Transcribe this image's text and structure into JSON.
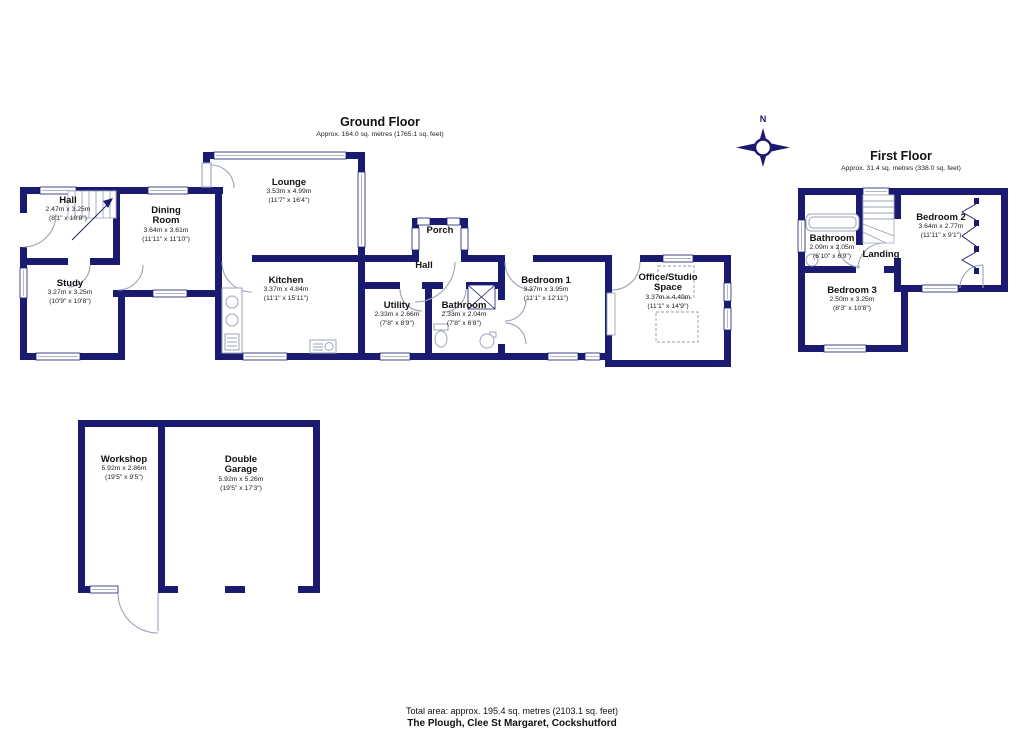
{
  "colors": {
    "wall": "#1a1a70",
    "fixture_line": "#9aa3b8"
  },
  "compass": {
    "north_label": "N"
  },
  "ground_floor": {
    "title": "Ground Floor",
    "subtitle": "Approx. 164.0 sq. metres (1765.1 sq. feet)",
    "rooms": [
      {
        "name": "Hall",
        "dim_m": "2.47m x 3.25m",
        "dim_ft": "(8'1\" x 10'8\")"
      },
      {
        "name": "Dining Room",
        "dim_m": "3.64m x 3.61m",
        "dim_ft": "(11'11\" x 11'10\")"
      },
      {
        "name": "Study",
        "dim_m": "3.27m x 3.25m",
        "dim_ft": "(10'9\" x 10'8\")"
      },
      {
        "name": "Lounge",
        "dim_m": "3.53m x 4.99m",
        "dim_ft": "(11'7\" x 16'4\")"
      },
      {
        "name": "Kitchen",
        "dim_m": "3.37m x 4.84m",
        "dim_ft": "(11'1\" x 15'11\")"
      },
      {
        "name": "Porch"
      },
      {
        "name": "Hall"
      },
      {
        "name": "Utility",
        "dim_m": "2.33m x 2.66m",
        "dim_ft": "(7'8\" x 8'9\")"
      },
      {
        "name": "Bathroom",
        "dim_m": "2.33m x 2.04m",
        "dim_ft": "(7'8\" x 6'8\")"
      },
      {
        "name": "Bedroom 1",
        "dim_m": "3.37m x 3.95m",
        "dim_ft": "(11'1\" x 12'11\")"
      },
      {
        "name": "Office/Studio Space",
        "dim_m": "3.37m x 4.49m",
        "dim_ft": "(11'1\" x 14'9\")"
      }
    ]
  },
  "first_floor": {
    "title": "First Floor",
    "subtitle": "Approx. 31.4 sq. metres (338.0 sq. feet)",
    "rooms": [
      {
        "name": "Bathroom",
        "dim_m": "2.09m x 2.05m",
        "dim_ft": "(6'10\" x 6'9\")"
      },
      {
        "name": "Bedroom 2",
        "dim_m": "3.64m x 2.77m",
        "dim_ft": "(11'11\" x 9'1\")"
      },
      {
        "name": "Landing"
      },
      {
        "name": "Bedroom 3",
        "dim_m": "2.50m x 3.25m",
        "dim_ft": "(8'3\" x 10'8\")"
      }
    ]
  },
  "outbuilding": {
    "rooms": [
      {
        "name": "Workshop",
        "dim_m": "5.92m x 2.86m",
        "dim_ft": "(19'5\" x 9'5\")"
      },
      {
        "name": "Double Garage",
        "dim_m": "5.92m x 5.26m",
        "dim_ft": "(19'5\" x 17'3\")"
      }
    ]
  },
  "footer": {
    "total_area": "Total area: approx. 195.4 sq. metres (2103.1 sq. feet)",
    "address": "The Plough, Clee St Margaret, Cockshutford"
  }
}
